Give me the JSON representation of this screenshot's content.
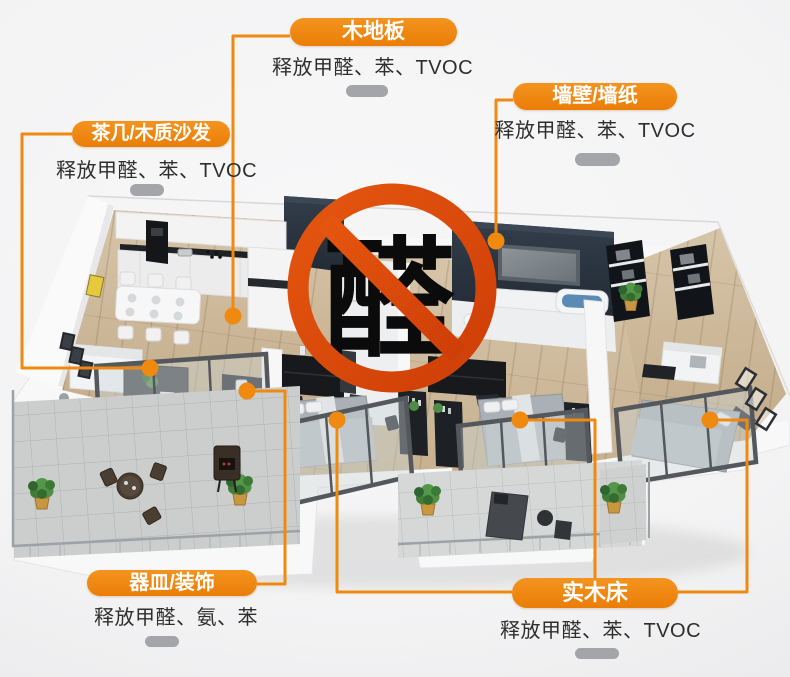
{
  "ban_sign": {
    "character": "醛"
  },
  "callouts": [
    {
      "id": "wood-floor",
      "label": "木地板",
      "description": "释放甲醛、苯、TVOC"
    },
    {
      "id": "wall-wallpaper",
      "label": "墙壁/墙纸",
      "description": "释放甲醛、苯、TVOC"
    },
    {
      "id": "coffee-table-sofa",
      "label": "茶几/木质沙发",
      "description": "释放甲醛、苯、TVOC"
    },
    {
      "id": "utensils-decor",
      "label": "器皿/装饰",
      "description": "释放甲醛、氨、苯"
    },
    {
      "id": "solid-wood-bed",
      "label": "实木床",
      "description": "释放甲醛、苯、TVOC"
    }
  ],
  "colors": {
    "accent_orange": "#EE8411",
    "connector_orange": "#F0890F",
    "ban_red": "#DC4A10",
    "body_text": "#2E2E2E",
    "divider_gray": "#A4A5A8",
    "navy_wall": "#2A333F",
    "wood_floor": "#CBB79B"
  }
}
